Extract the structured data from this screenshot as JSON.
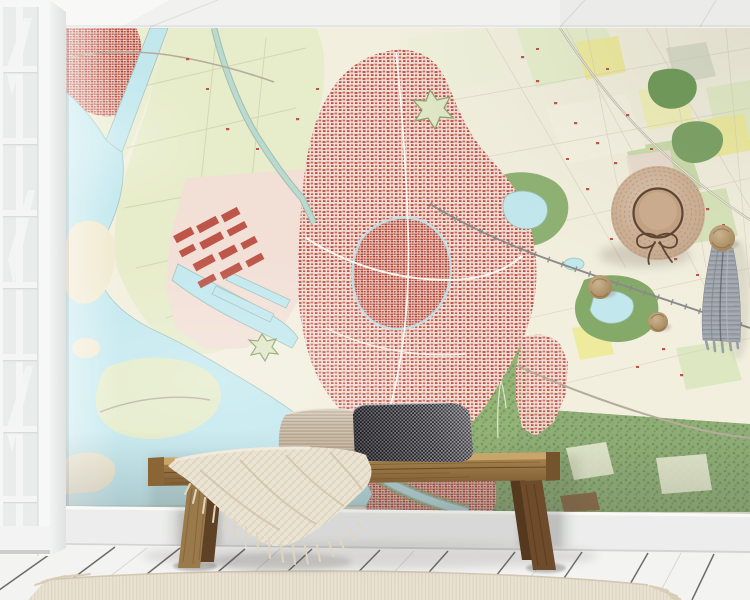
{
  "meta": {
    "title": "Wall mural mockup - topographic city map wallpaper in a styled interior",
    "visible_text": "none"
  },
  "scene": {
    "wall_art": {
      "kind": "map wallpaper mural",
      "style": "Dutch topographic map",
      "features": [
        "harbor city",
        "canals",
        "polder fields",
        "bay with islands",
        "industrial quay with red warehouses",
        "parks and forests",
        "railway",
        "star fort",
        "countryside field patchwork"
      ]
    },
    "objects": [
      {
        "name": "paneled-window",
        "position": "left edge"
      },
      {
        "name": "ceiling",
        "position": "top"
      },
      {
        "name": "straw-hat",
        "position": "upper right wall"
      },
      {
        "name": "wall-knob",
        "count": 3,
        "position": "right wall"
      },
      {
        "name": "hanging-scarf",
        "position": "below right knob"
      },
      {
        "name": "wooden-bench",
        "position": "bottom center"
      },
      {
        "name": "knit-throw-blanket",
        "position": "draped over bench, left"
      },
      {
        "name": "woven-pillow-light",
        "position": "on bench"
      },
      {
        "name": "check-pillow-dark",
        "position": "on bench"
      },
      {
        "name": "baseboard",
        "position": "bottom wall"
      },
      {
        "name": "plank-floor",
        "position": "bottom"
      },
      {
        "name": "area-rug",
        "position": "bottom foreground"
      }
    ]
  },
  "palette": {
    "ceiling": "#f1f1ef",
    "window_frame": "#f5f6f5",
    "window_glass": "#e9eceb",
    "jamb": "#eceeed",
    "map_cream": "#f2efde",
    "map_water": "#c2e8ee",
    "map_polder": "#e7ecca",
    "map_urban_pink": "#f0ddd5",
    "map_building_red": "#bd5649",
    "map_forest": "#7ca264",
    "map_forest_dark": "#6f9b59",
    "map_green_mid": "#cbdcab",
    "map_yellow": "#eeeb9f",
    "map_road": "#b4ad9d",
    "map_rail": "#8a8a88",
    "baseboard": "#ecedec",
    "floor": "#f3f3f1",
    "floor_seam": "#4b4b4b",
    "rug": "#e9e2d2",
    "bench_seat_top": "#c9a86a",
    "bench_wood_light": "#9a7a4b",
    "bench_wood_dark": "#6e4c2b",
    "bench_leg_rear": "#5f4126",
    "blanket": "#eae2d0",
    "blanket_fringe": "#e0d5bf",
    "pillow_light": "#c4b49f",
    "pillow_dark": "#97979c",
    "straw": "#c7a98c",
    "straw_crown": "#c2a183",
    "ribbon": "#5f4533",
    "knob_wood": "#b3925f",
    "scarf": "#9aa0a8"
  }
}
